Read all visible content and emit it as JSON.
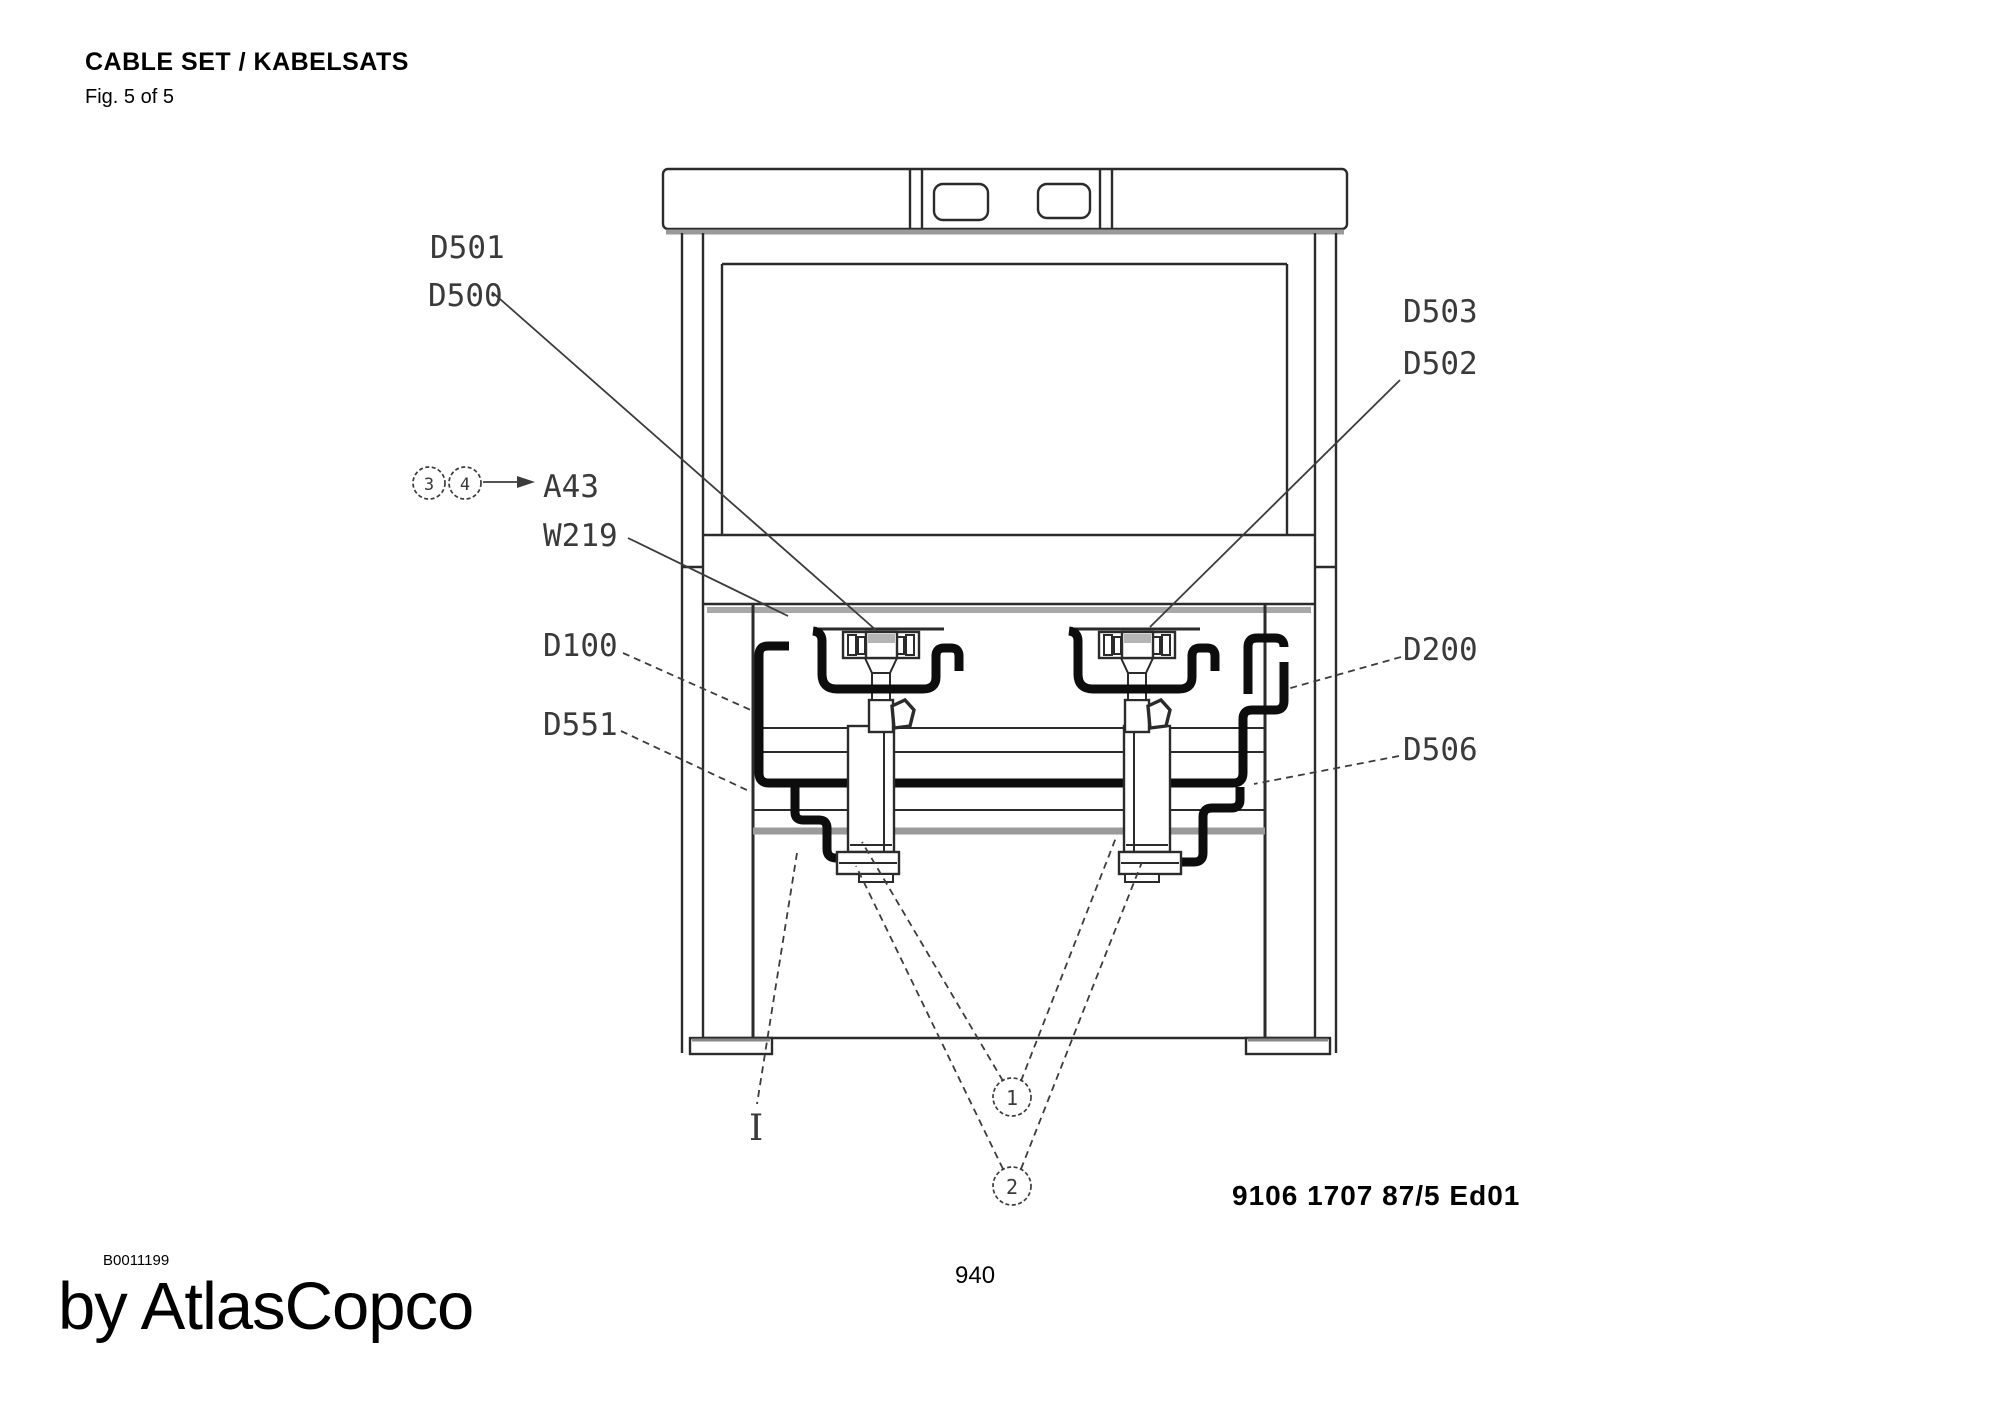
{
  "page": {
    "title": "CABLE SET / KABELSATS",
    "figure_caption": "Fig. 5 of 5",
    "doc_number": "9106 1707 87/5  Ed01",
    "page_number": "940",
    "image_ref": "B0011199",
    "watermark": "by AtlasCopco"
  },
  "drawing": {
    "part_labels": {
      "d501": "D501",
      "d500": "D500",
      "d503": "D503",
      "d502": "D502",
      "a43": "A43",
      "w219": "W219",
      "d100": "D100",
      "d551": "D551",
      "d200": "D200",
      "d506": "D506",
      "section_mark": "I"
    },
    "callouts": {
      "c1": "1",
      "c2": "2",
      "c3": "3",
      "c4": "4"
    },
    "colors": {
      "line": "#2b2b2b",
      "cable": "#0d0d0d",
      "shadow": "#9a9a9a",
      "fill_gray": "#b5b5b5"
    }
  }
}
